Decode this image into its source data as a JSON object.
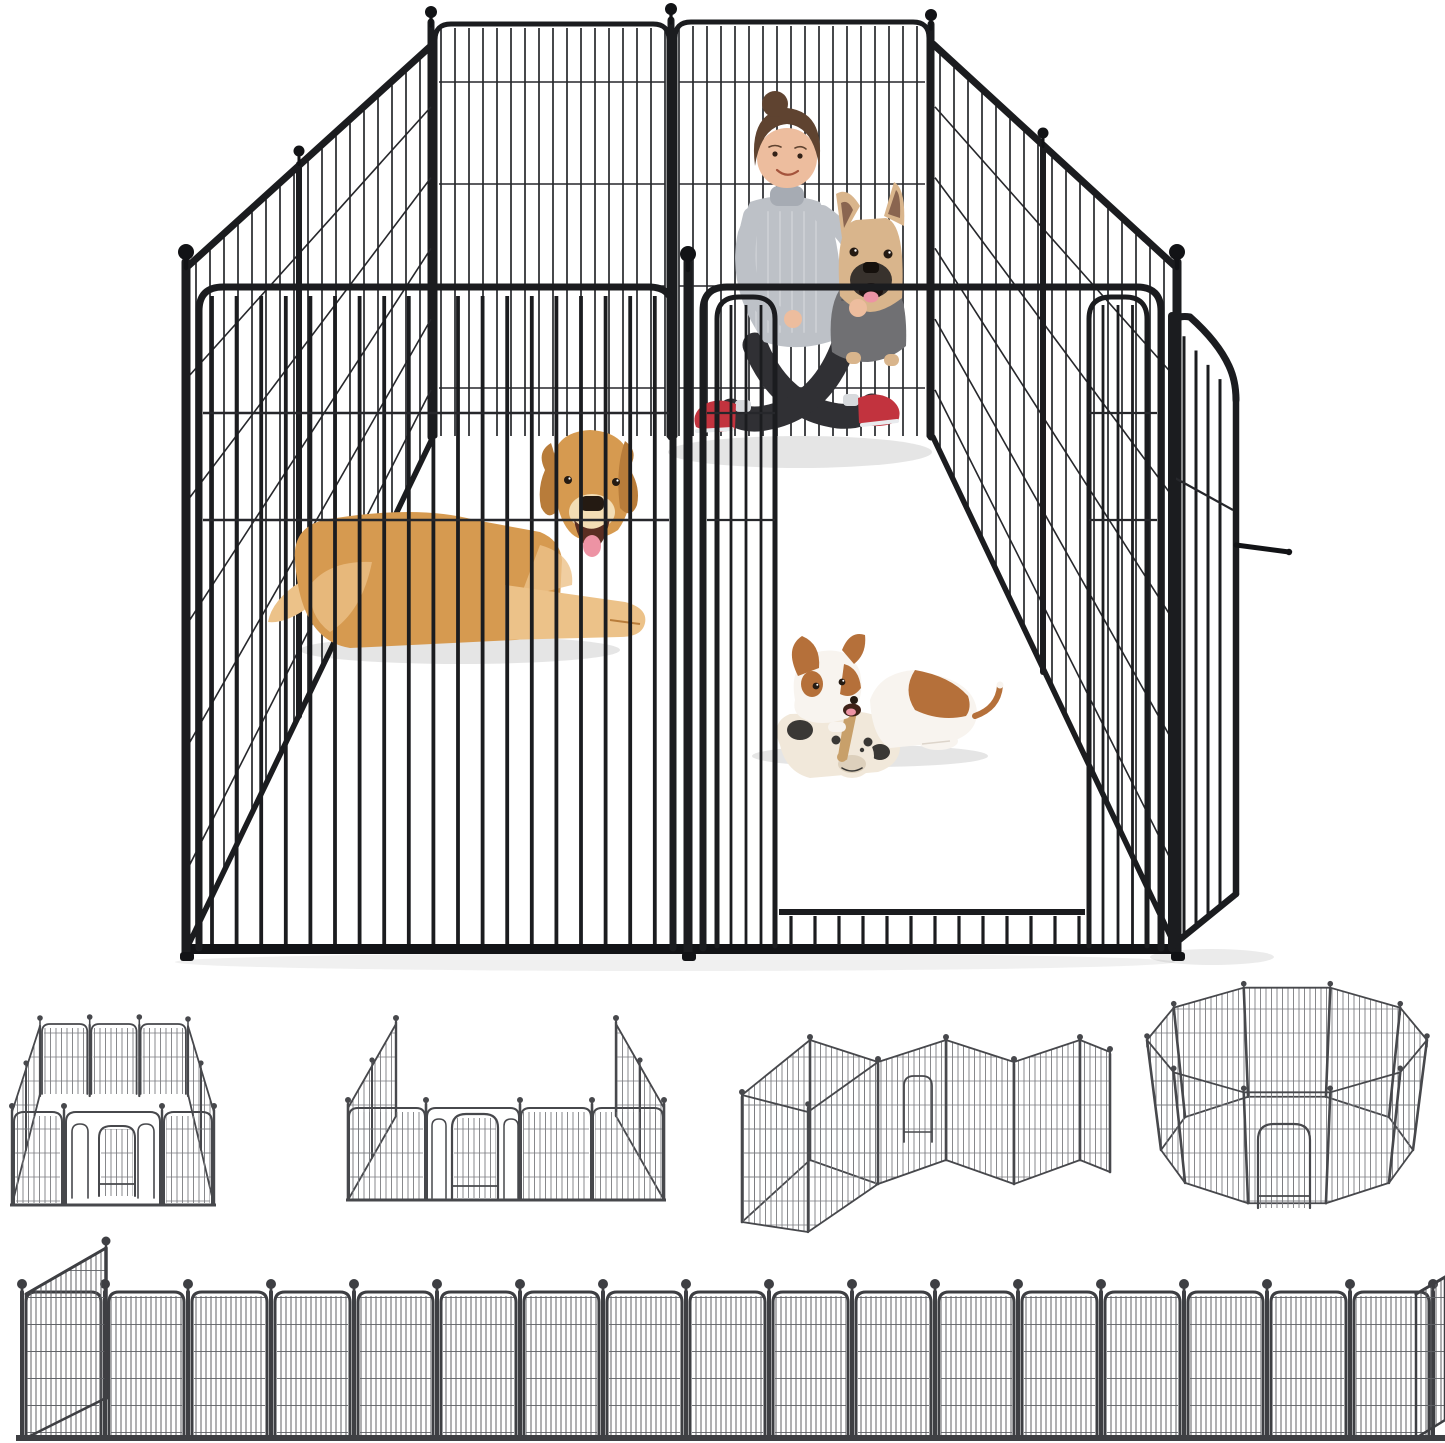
{
  "figure": {
    "kind": "product-photo",
    "subject": "heavy-duty metal dog playpen fence with woman and three dogs inside",
    "background": "#ffffff"
  },
  "palette": {
    "floor": "#ffffff",
    "pen_frame": "#1b1c1f",
    "pen_wire": "#26272b",
    "pen_deep": "#121316",
    "thumb_frame": "#47484c",
    "thumb_wire": "#7a7c80",
    "row_frame": "#3e3f43",
    "row_wire": "#606266",
    "shadow": "#000000",
    "skin": "#edbd9e",
    "hair": "#5f4330",
    "sweater": "#bdc1c7",
    "sweater_shade": "#a6abb3",
    "leggings": "#303034",
    "shoe_red": "#c2333e",
    "sole": "#e9ebee",
    "sock": "#d7dadd",
    "bulldog_fawn": "#d9b58c",
    "bulldog_inner_ear": "#8a6550",
    "bulldog_mask": "#38322d",
    "bulldog_mouth": "#1c1210",
    "hoodie": "#707073",
    "tongue": "#ed93a4",
    "retriever_coat": "#d69a50",
    "retriever_light": "#ecc289",
    "retriever_dark": "#b87c3a",
    "retriever_muzzle": "#f3ddb4",
    "retriever_mouth": "#5a2e22",
    "nose_dark": "#241a12",
    "puppy_white": "#f8f4ef",
    "puppy_brown": "#b5703a",
    "puppy_mouth": "#402318",
    "plush_cream": "#f1e8da",
    "plush_shade": "#ddd0bc",
    "plush_patch": "#3a3835",
    "stick": "#c8a06a",
    "eye_glint": "#ffffff"
  },
  "main_pen": {
    "back_panels": 2,
    "side_panels_per_side": 2,
    "front_left_panel_bars": 19,
    "gate": {
      "door_state": "open",
      "has_latch": true,
      "kick_bars": 13
    },
    "finial_style": "ball",
    "horizontal_wire_rows_back": [
      82,
      184,
      286,
      388
    ],
    "front_wire_rows": [
      413,
      520
    ]
  },
  "characters": {
    "woman": {
      "hair": "brown bun",
      "top": "light gray turtleneck sweater",
      "pants": "dark leggings",
      "shoes": "red sneakers",
      "pose": "sitting cross-legged",
      "holding": "french bulldog"
    },
    "french_bulldog": {
      "coat": "fawn",
      "outfit": "gray hoodie",
      "mouth": "open"
    },
    "golden_retriever": {
      "pose": "lying down",
      "expression": "smiling, tongue out"
    },
    "jack_russell_puppy": {
      "pose": "lying, chewing a stick",
      "toy": "plush cow"
    }
  },
  "configurations": [
    {
      "name": "rectangle-pen",
      "panels_visible": 8
    },
    {
      "name": "open-sided-pen",
      "panels_visible": 8
    },
    {
      "name": "two-room-zigzag-pen",
      "panels_visible": 9
    },
    {
      "name": "octagon-pen",
      "panels_visible": 10
    }
  ],
  "fence_row": {
    "front_panels": 17,
    "end_panels": 2,
    "finial_style": "ball"
  }
}
